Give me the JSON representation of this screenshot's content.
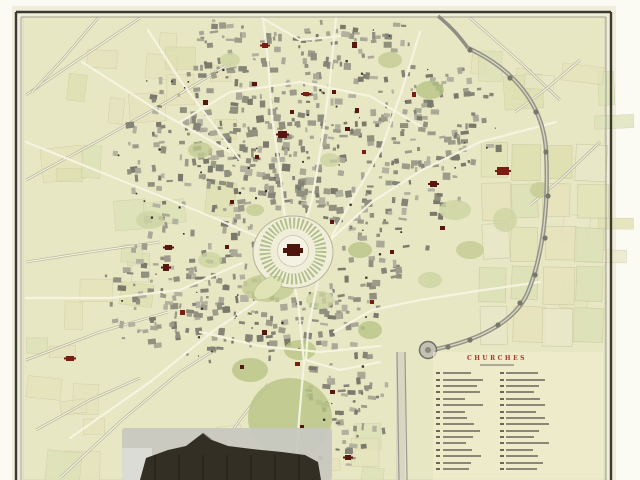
{
  "map": {
    "palette": {
      "scan_margin": "#fbfaf3",
      "paper": "#f0eedb",
      "field": "#e8e7c3",
      "field_edge": "#c9c8ac",
      "frame": "#3a3a31",
      "frame_inner": "#8b8b79",
      "plot_fills": [
        "#e4e4ba",
        "#dee0b0",
        "#e9e7c8",
        "#dde2b8",
        "#e6e3bd"
      ],
      "plot_stroke": "#c7c7a2",
      "block_fills": [
        "#90907f",
        "#9d9c8b",
        "#848477",
        "#aaa997",
        "#79796c",
        "#b3b2a1"
      ],
      "street": "#f6f4e2",
      "road_casing": "#b4b499",
      "green_fills": [
        "#c3cc92",
        "#b7c486",
        "#cdd4a2"
      ],
      "church": "#571610",
      "church_bright": "#7a1d12",
      "dot": "#35352b",
      "wall": "#8f8f85",
      "wall_light": "#d9d7c2",
      "mound_ring": "#a9b87f",
      "mound_fill": "#f0eed9",
      "mound_inner": "#f4f3e3",
      "keep": "#4e150c",
      "tower_fill": "#c2c1b2",
      "tower_stroke": "#70706a",
      "vignette_sky": "#c8c8c1",
      "vignette_light": "#dcdcd6",
      "vignette_dark": "#332f24",
      "legend_bg": "#efedcd",
      "legend_text_bar": "#77776a",
      "legend_num_bar": "#6a6a5a"
    },
    "legend": {
      "title": "CHURCHES",
      "title_color": "#a03a2a",
      "columns": 2,
      "rows_per_column": 16
    },
    "features": [
      "castle-mound",
      "castle-keep",
      "street-network",
      "building-blocks",
      "church-markers",
      "city-wall",
      "field-plots",
      "round-tower",
      "legend-table",
      "vignette-engraving"
    ]
  }
}
